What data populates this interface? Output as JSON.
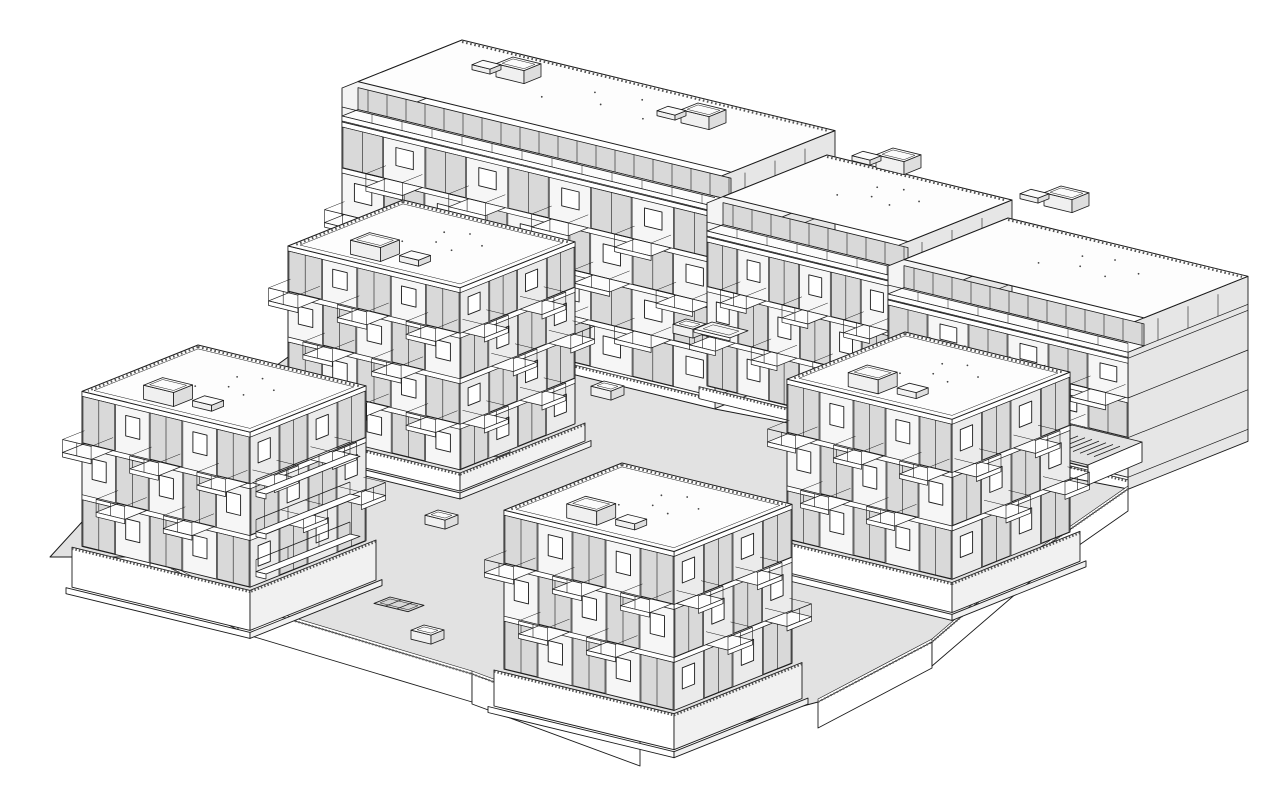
{
  "scene": {
    "kind": "axonometric-architectural-line-drawing",
    "subject": "residential-housing-complex-on-shared-podium",
    "buildings_count": 5
  },
  "palette": {
    "background": "#ffffff",
    "line": "#1b1b1b",
    "ground": "#e2e2e2",
    "ground_dark": "#d6d6d6",
    "face_sw": "#f6f6f6",
    "face_se": "#ebebeb",
    "face_end": "#e6e6e6",
    "glazing": "#d9d9d9",
    "roof": "#fdfdfd",
    "white": "#ffffff",
    "hatch": "#555555"
  },
  "projection": {
    "ux": 1,
    "uy": 0.243,
    "vx": -1,
    "vy": 0.4
  },
  "slab": {
    "name": "building-long-slab",
    "pent_h": 28,
    "pent_inset": 16,
    "segments": [
      {
        "n": [
          462,
          40
        ],
        "w": 373,
        "d": 120,
        "h": 230,
        "stories": 4
      },
      {
        "n": [
          827,
          155
        ],
        "w": 185,
        "d": 120,
        "h": 195,
        "stories": 3
      },
      {
        "n": [
          1008,
          218
        ],
        "w": 240,
        "d": 120,
        "h": 165,
        "stories": 3
      }
    ],
    "roof_boxes": [
      [
        513,
        70
      ],
      [
        698,
        116
      ],
      [
        893,
        161
      ],
      [
        1061,
        199
      ]
    ]
  },
  "towers": [
    {
      "name": "tower-block-northwest",
      "n": [
        403,
        200
      ],
      "w": 172,
      "d": 115,
      "h": 200,
      "stories": 4,
      "plinth": 18
    },
    {
      "name": "tower-block-east",
      "n": [
        905,
        332
      ],
      "w": 165,
      "d": 118,
      "h": 190,
      "stories": 3,
      "plinth": 30
    },
    {
      "name": "tower-block-west",
      "n": [
        198,
        345
      ],
      "w": 168,
      "d": 116,
      "h": 195,
      "stories": 3,
      "plinth": 40
    },
    {
      "name": "tower-block-south",
      "n": [
        622,
        463
      ],
      "w": 170,
      "d": 118,
      "h": 195,
      "stories": 3,
      "plinth": 36
    }
  ],
  "podium": {
    "outline": [
      [
        342,
        318
      ],
      [
        715,
        409
      ],
      [
        892,
        443
      ],
      [
        1128,
        489
      ],
      [
        1032,
        556
      ],
      [
        932,
        642
      ],
      [
        818,
        702
      ],
      [
        668,
        742
      ],
      [
        472,
        674
      ],
      [
        238,
        604
      ],
      [
        150,
        557
      ],
      [
        50,
        557
      ],
      [
        124,
        476
      ]
    ],
    "fascia_edges": [
      [
        [
          150,
          557
        ],
        [
          238,
          604
        ],
        26
      ],
      [
        [
          238,
          604
        ],
        [
          472,
          674
        ],
        28
      ],
      [
        [
          472,
          674
        ],
        [
          640,
          736
        ],
        30
      ],
      [
        [
          818,
          702
        ],
        [
          932,
          642
        ],
        26
      ],
      [
        [
          932,
          642
        ],
        [
          1032,
          556
        ],
        24
      ],
      [
        [
          1032,
          556
        ],
        [
          1128,
          489
        ],
        22
      ]
    ]
  },
  "courtyard": {
    "vents": [
      [
        686,
        328
      ],
      [
        604,
        390
      ],
      [
        490,
        447
      ],
      [
        438,
        519
      ],
      [
        424,
        634
      ],
      [
        288,
        591
      ]
    ],
    "pad_raised": {
      "o": [
        712,
        322
      ],
      "w": 36,
      "d": 18
    },
    "pad_recessed": {
      "o": [
        390,
        597
      ],
      "w": 34,
      "d": 16
    }
  },
  "ramp": {
    "name": "terraced-ramp-east",
    "terraces": [
      [
        [
          1002,
          408
        ],
        [
          1072,
          425
        ],
        [
          1018,
          448
        ],
        [
          948,
          431
        ]
      ],
      [
        [
          1018,
          448
        ],
        [
          1072,
          425
        ],
        [
          1142,
          442
        ],
        [
          1088,
          465
        ]
      ]
    ],
    "fascia": [
      [
        1088,
        465
      ],
      [
        1142,
        442
      ],
      [
        1142,
        462
      ],
      [
        1088,
        485
      ]
    ],
    "hatch_origin": [
      1078,
      436
    ],
    "hatch_n": 7,
    "hatch_step": [
      7,
      1.7
    ],
    "hatch_len": 26
  },
  "bridges": {
    "name": "balcony-bridges-west-gap",
    "anchors": [
      [
        350,
        454
      ],
      [
        350,
        494
      ],
      [
        350,
        534
      ]
    ],
    "length": 94
  },
  "roof_specks": [
    [
      0.44,
      0.3
    ],
    [
      0.55,
      0.24
    ],
    [
      0.5,
      0.46
    ],
    [
      0.63,
      0.52
    ],
    [
      0.37,
      0.56
    ],
    [
      0.7,
      0.36
    ]
  ]
}
